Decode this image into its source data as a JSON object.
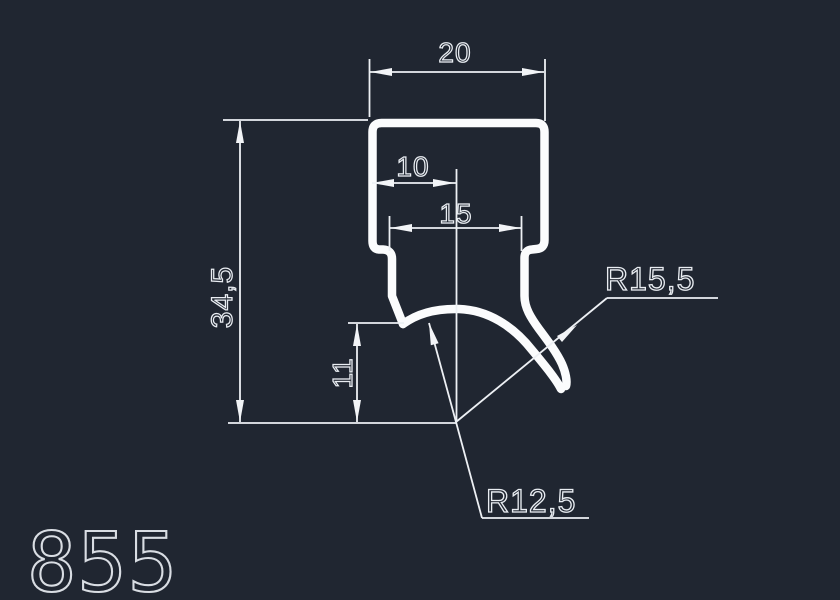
{
  "drawing": {
    "part_number": "855",
    "background_color": "#202631",
    "profile_line_color": "#fbfcfd",
    "dimension_line_color": "#edf0f4",
    "dimensions": {
      "cap_width": "20",
      "half_width": "10",
      "leg_span": "15",
      "total_height": "34,5",
      "lip_height": "11",
      "radius_outer": "R15,5",
      "radius_inner": "R12,5"
    }
  }
}
